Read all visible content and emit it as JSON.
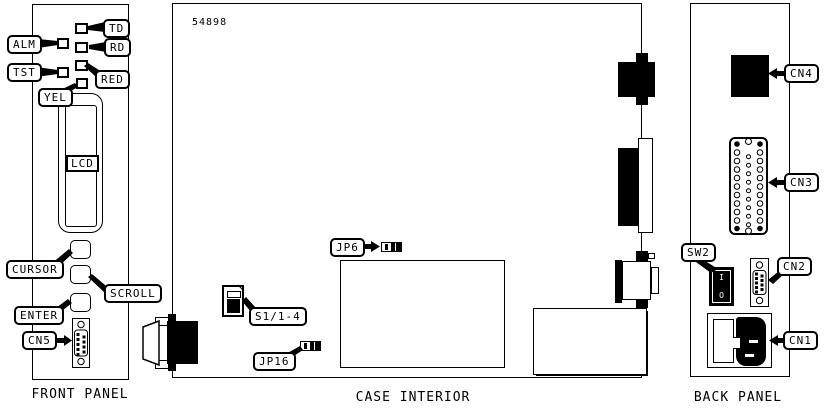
{
  "colors": {
    "ink": "#000000",
    "paper": "#ffffff"
  },
  "front_panel": {
    "title": "FRONT PANEL",
    "leds": {
      "alm": "ALM",
      "tst": "TST",
      "td": "TD",
      "rd": "RD",
      "red": "RED",
      "yel": "YEL"
    },
    "lcd": "LCD",
    "buttons": {
      "cursor": "CURSOR",
      "scroll": "SCROLL",
      "enter": "ENTER"
    },
    "connectors": {
      "cn5": "CN5"
    }
  },
  "case_interior": {
    "title": "CASE INTERIOR",
    "part_number": "54898",
    "components": {
      "jp6": "JP6",
      "s1": "S1/1-4",
      "jp16": "JP16"
    }
  },
  "back_panel": {
    "title": "BACK PANEL",
    "connectors": {
      "cn4": "CN4",
      "cn3": "CN3",
      "cn2": "CN2",
      "cn1": "CN1"
    },
    "switch": {
      "label": "SW2",
      "on": "I",
      "off": "O"
    }
  }
}
